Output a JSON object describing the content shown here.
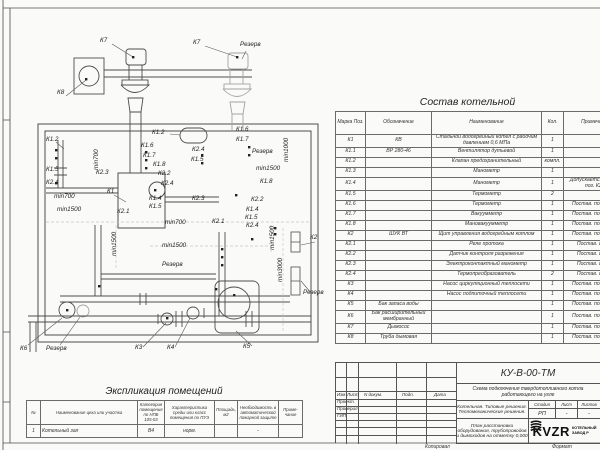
{
  "drawing": {
    "labels": [
      {
        "t": "К7",
        "x": 100,
        "y": 38
      },
      {
        "t": "К8",
        "x": 57,
        "y": 90
      },
      {
        "t": "К7",
        "x": 193,
        "y": 40
      },
      {
        "t": "Резерв",
        "x": 240,
        "y": 42
      },
      {
        "t": "К1.2",
        "x": 46,
        "y": 137
      },
      {
        "t": "К1.5",
        "x": 46,
        "y": 167
      },
      {
        "t": "К2.4",
        "x": 46,
        "y": 180
      },
      {
        "t": "min700",
        "x": 54,
        "y": 194
      },
      {
        "t": "min1500",
        "x": 57,
        "y": 207
      },
      {
        "t": "min700",
        "x": 94,
        "y": 170,
        "v": 1
      },
      {
        "t": "К1.2",
        "x": 152,
        "y": 130
      },
      {
        "t": "К1.6",
        "x": 141,
        "y": 143
      },
      {
        "t": "К1.7",
        "x": 143,
        "y": 153
      },
      {
        "t": "К1.8",
        "x": 153,
        "y": 162
      },
      {
        "t": "К2.2",
        "x": 158,
        "y": 171
      },
      {
        "t": "К2.3",
        "x": 96,
        "y": 170
      },
      {
        "t": "К2.4",
        "x": 161,
        "y": 181
      },
      {
        "t": "К1",
        "x": 107,
        "y": 189
      },
      {
        "t": "К1.4",
        "x": 149,
        "y": 196
      },
      {
        "t": "К1.5",
        "x": 149,
        "y": 204
      },
      {
        "t": "К2.1",
        "x": 117,
        "y": 209
      },
      {
        "t": "К1.6",
        "x": 236,
        "y": 127
      },
      {
        "t": "К1.7",
        "x": 236,
        "y": 137
      },
      {
        "t": "Резерв",
        "x": 252,
        "y": 149
      },
      {
        "t": "min1000",
        "x": 284,
        "y": 162,
        "v": 1
      },
      {
        "t": "К2.4",
        "x": 192,
        "y": 147
      },
      {
        "t": "К1.5",
        "x": 191,
        "y": 157
      },
      {
        "t": "min1500",
        "x": 256,
        "y": 166
      },
      {
        "t": "К1.8",
        "x": 260,
        "y": 179
      },
      {
        "t": "К2.2",
        "x": 251,
        "y": 197
      },
      {
        "t": "К1.4",
        "x": 246,
        "y": 207
      },
      {
        "t": "К1.5",
        "x": 245,
        "y": 215
      },
      {
        "t": "К2.4",
        "x": 246,
        "y": 223
      },
      {
        "t": "К2.3",
        "x": 192,
        "y": 196
      },
      {
        "t": "К2.1",
        "x": 212,
        "y": 219
      },
      {
        "t": "min700",
        "x": 165,
        "y": 220
      },
      {
        "t": "min1500",
        "x": 162,
        "y": 243
      },
      {
        "t": "Резерв",
        "x": 162,
        "y": 262
      },
      {
        "t": "min1500",
        "x": 112,
        "y": 256,
        "v": 1
      },
      {
        "t": "min1500",
        "x": 270,
        "y": 250,
        "v": 1
      },
      {
        "t": "min3000",
        "x": 278,
        "y": 282,
        "v": 1
      },
      {
        "t": "К2",
        "x": 310,
        "y": 235
      },
      {
        "t": "Резерв",
        "x": 303,
        "y": 290
      },
      {
        "t": "К6",
        "x": 20,
        "y": 346
      },
      {
        "t": "Резерв",
        "x": 46,
        "y": 346
      },
      {
        "t": "К3",
        "x": 135,
        "y": 345
      },
      {
        "t": "К4",
        "x": 167,
        "y": 345
      },
      {
        "t": "К5",
        "x": 243,
        "y": 344
      }
    ]
  },
  "spec_table": {
    "title": "Состав котельной",
    "headers": [
      "Марка Поз.",
      "Обозначение",
      "Наименование",
      "Кол.",
      "Примечание"
    ],
    "rows": [
      [
        "К1",
        "КВ",
        "Стальной водогрейный котел с рабочим давлением 0,6 МПа",
        "1",
        ""
      ],
      [
        "К1.1",
        "ВР 280-46",
        "Вентилятор дутьевой",
        "1",
        ""
      ],
      [
        "К1.2",
        "",
        "Клапан предохранительный",
        "компл.",
        ""
      ],
      [
        "К1.3",
        "",
        "Манометр",
        "1",
        ""
      ],
      [
        "К1.4",
        "",
        "Манометр",
        "1",
        "Допускается замена поз. К2.3"
      ],
      [
        "К1.5",
        "",
        "Термометр",
        "2",
        ""
      ],
      [
        "К1.6",
        "",
        "Термометр",
        "1",
        "Постав. по соглас."
      ],
      [
        "К1.7",
        "",
        "Вакуумметр",
        "1",
        "Постав. по соглас."
      ],
      [
        "К1.8",
        "",
        "Мановакуумметр",
        "1",
        "Постав. по соглас."
      ],
      [
        "К2",
        "ШУК ВТ",
        "Щит управления водогрейным котлом",
        "1",
        "Постав. по соглас."
      ],
      [
        "К2.1",
        "",
        "Реле протока",
        "1",
        "Постав. с ШУК"
      ],
      [
        "К2.2",
        "",
        "Датчик контроля разрежения",
        "1",
        "Постав. с ШУК"
      ],
      [
        "К2.3",
        "",
        "Электроконтактный манометр",
        "1",
        "Постав. с ШУК"
      ],
      [
        "К2.4",
        "",
        "Термопреобразователь",
        "2",
        "Постав. с ШУК"
      ],
      [
        "К3",
        "",
        "Насос циркуляционный теплосети",
        "1",
        "Постав. по соглас."
      ],
      [
        "К4",
        "",
        "Насос подпиточный теплосети",
        "1",
        "Постав. по соглас."
      ],
      [
        "К5",
        "Бак запаса воды",
        "",
        "1",
        "Постав. по соглас."
      ],
      [
        "К6",
        "Бак расширительный мембранный",
        "",
        "1",
        "Постав. по соглас."
      ],
      [
        "К7",
        "Дымосос",
        "",
        "1",
        "Постав. по соглас."
      ],
      [
        "К8",
        "Труба дымовая",
        "",
        "1",
        "Постав. по соглас."
      ]
    ]
  },
  "explication": {
    "title": "Экспликация помещений",
    "headers": [
      "№",
      "Наименование цеха или участка",
      "Категория помещения по НПБ 105-03",
      "Характеристика среды или класс помещения по ПУЭ",
      "Площадь, м2",
      "Необходимость в автоматической пожарной защите",
      "Приме-чание"
    ],
    "rows": [
      [
        "1",
        "Котельный зал",
        "В4",
        "норм.",
        "",
        "-",
        ""
      ]
    ]
  },
  "title_block": {
    "doc_number": "КУ-В-00-ТМ",
    "subtitle": "Схема подключения твердотопливного котла работающего на угле",
    "rev_headers": [
      "Изм",
      "Лист",
      "N докум.",
      "Подп.",
      "Дата"
    ],
    "roles": [
      "Проект.",
      "Проверил",
      "ГИП"
    ],
    "project_name": "Котельная. Типовые решения. Тепломеханические решения.",
    "sheet_title": "План расстановки оборудования, трубопроводов и дымоходов на отметку 0,000",
    "stage_label": "Стадия",
    "stage_value": "РП",
    "list_label": "Лист",
    "list_value": "-",
    "listov_label": "Листов",
    "listov_value": "-",
    "logo_text": "KVZR",
    "company_line1": "КОТЕЛЬНЫЙ",
    "company_line2": "ЗАВОД Р",
    "footer_copy": "Копировал",
    "footer_format": "Формат"
  }
}
